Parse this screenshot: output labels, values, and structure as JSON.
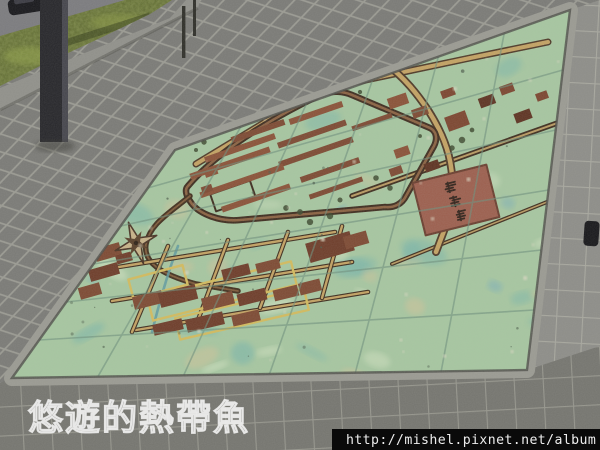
{
  "watermark": {
    "text": "悠遊的熱帶魚"
  },
  "url_bar": {
    "text": "http://mishel.pixnet.net/album",
    "bg": "#0a0a0a",
    "fg": "#ededed"
  },
  "palette": {
    "paver_upper": "#7a7a76",
    "paver_right": "#8d8d88",
    "paver_lower": "#75756f",
    "grout": "#9a9a92",
    "curb": "#90908a",
    "asphalt": "#7b7b7e",
    "grass": "#5c682e",
    "grass_light": "#93a34b",
    "pole": "#26262a",
    "map_green": "#a6c6a0",
    "map_teal": "#79b5aa",
    "map_sand": "#cdc39a",
    "map_pale": "#d8e6c6",
    "map_grout": "#6e8f7c",
    "frame": "#9a9a92",
    "seam": "#4e4e48",
    "building": "#7d4a33",
    "building_alt": "#8a5238",
    "dark_line": "#3f2e1f",
    "road_tan": "#c3a263",
    "town_yellow": "#d2bb5e",
    "cartouche": "#9c5f4e",
    "compass_light": "#c7b288",
    "compass_dark": "#4a3526",
    "stream_teal": "#5f9aa0"
  },
  "map": {
    "tiles_per_side": 6,
    "cartouche": {
      "glyph_count": 3
    },
    "buildings": [
      [
        258,
        131,
        56,
        6
      ],
      [
        316,
        113,
        56,
        6
      ],
      [
        372,
        122,
        42,
        5
      ],
      [
        240,
        148,
        74,
        6
      ],
      [
        312,
        134,
        72,
        6
      ],
      [
        230,
        163,
        84,
        6
      ],
      [
        316,
        152,
        78,
        6
      ],
      [
        242,
        181,
        88,
        6
      ],
      [
        330,
        170,
        62,
        6
      ],
      [
        256,
        198,
        72,
        6
      ],
      [
        336,
        188,
        56,
        5
      ],
      [
        211,
        172,
        13,
        8
      ],
      [
        207,
        189,
        11,
        7
      ],
      [
        402,
        152,
        15,
        9
      ],
      [
        396,
        171,
        13,
        8
      ],
      [
        398,
        101,
        20,
        11
      ],
      [
        420,
        112,
        16,
        9
      ]
    ],
    "scatter": [
      [
        457,
        121,
        22,
        15
      ],
      [
        487,
        101,
        16,
        10
      ],
      [
        507,
        89,
        14,
        9
      ],
      [
        523,
        116,
        17,
        10
      ],
      [
        542,
        96,
        12,
        8
      ],
      [
        432,
        166,
        15,
        9
      ],
      [
        352,
        81,
        15,
        8
      ],
      [
        381,
        73,
        13,
        7
      ],
      [
        448,
        93,
        14,
        8
      ]
    ],
    "town_blocks": [
      [
        108,
        252,
        26,
        13,
        -16
      ],
      [
        104,
        272,
        30,
        12,
        -16
      ],
      [
        90,
        291,
        22,
        12,
        -16
      ],
      [
        124,
        258,
        16,
        9,
        -16
      ],
      [
        148,
        300,
        30,
        13,
        -14
      ],
      [
        178,
        296,
        38,
        15,
        -14
      ],
      [
        218,
        301,
        32,
        13,
        -14
      ],
      [
        252,
        297,
        29,
        12,
        -14
      ],
      [
        286,
        293,
        25,
        11,
        -14
      ],
      [
        330,
        247,
        46,
        20,
        -16
      ],
      [
        356,
        240,
        24,
        13,
        -16
      ],
      [
        236,
        272,
        28,
        11,
        -14
      ],
      [
        268,
        266,
        24,
        10,
        -14
      ],
      [
        205,
        322,
        38,
        13,
        -13
      ],
      [
        246,
        318,
        28,
        11,
        -13
      ],
      [
        168,
        327,
        30,
        11,
        -13
      ],
      [
        310,
        287,
        22,
        12,
        -14
      ]
    ],
    "yellow_blocks": [
      [
        222,
        291,
        148,
        24,
        -14
      ],
      [
        242,
        314,
        132,
        22,
        -13
      ],
      [
        158,
        282,
        56,
        20,
        -15
      ]
    ],
    "streets_a": [
      [
        100,
        270,
        335,
        232
      ],
      [
        112,
        301,
        352,
        262
      ],
      [
        136,
        330,
        368,
        292
      ]
    ],
    "streets_b": [
      [
        168,
        246,
        132,
        332
      ],
      [
        228,
        240,
        198,
        320
      ],
      [
        288,
        232,
        260,
        308
      ],
      [
        342,
        226,
        322,
        298
      ]
    ],
    "trees": [
      [
        196,
        150
      ],
      [
        204,
        142
      ],
      [
        286,
        208
      ],
      [
        300,
        212
      ],
      [
        340,
        200
      ],
      [
        360,
        92
      ],
      [
        336,
        86
      ],
      [
        452,
        148
      ],
      [
        462,
        140
      ],
      [
        245,
        120
      ],
      [
        255,
        112
      ],
      [
        420,
        136
      ],
      [
        430,
        180
      ],
      [
        310,
        222
      ],
      [
        330,
        216
      ],
      [
        376,
        178
      ],
      [
        390,
        188
      ],
      [
        472,
        130
      ]
    ]
  }
}
